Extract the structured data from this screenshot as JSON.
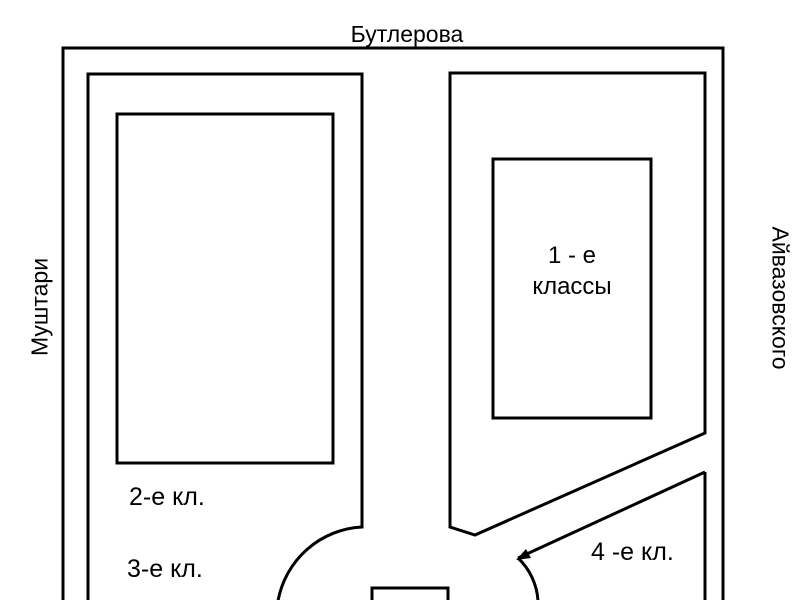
{
  "streets": {
    "top": "Бутлерова",
    "left": "Муштари",
    "right": "Айвазовского"
  },
  "areas": {
    "first": {
      "line1": "1 - е",
      "line2": "классы"
    },
    "second": "2-е кл.",
    "third": "3-е кл.",
    "fourth": "4 -е кл."
  },
  "colors": {
    "line": "#000000",
    "background": "#ffffff"
  }
}
